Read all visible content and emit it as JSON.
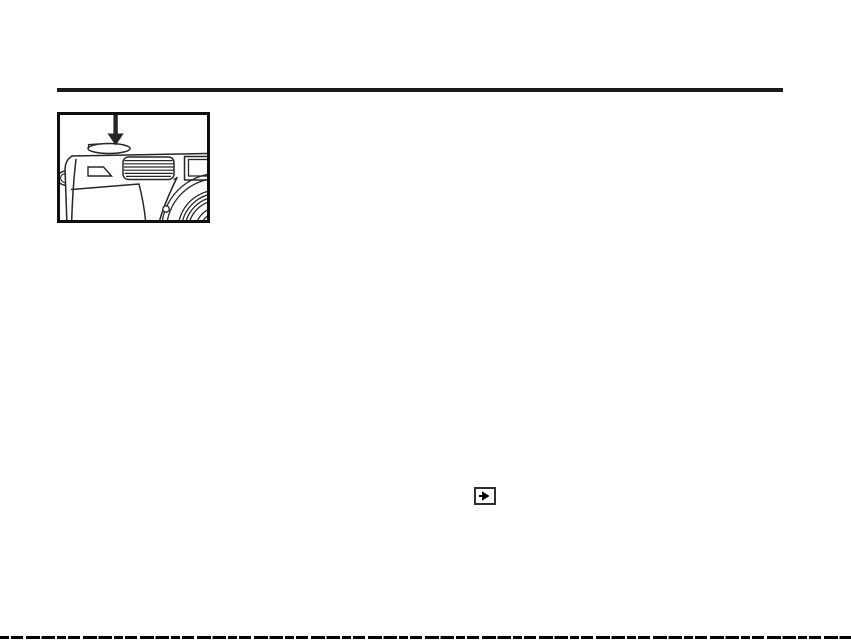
{
  "document": {
    "type": "scanned-manual-page",
    "background": "#ffffff",
    "visible_text": ""
  },
  "colors": {
    "rule": "#1b1b1b",
    "ink": "#262626",
    "frame": "#0f0f0f",
    "icon_border": "#2e2e2e",
    "icon_glyph": "#000000"
  },
  "figure": {
    "name": "camera-shutter-button-illustration",
    "alt": "Line drawing of the top-left corner of a compact camera with a bold arrow pointing down at the shutter button",
    "parts": [
      "down-arrow-icon",
      "shutter-button",
      "self-timer-window",
      "flash-grille",
      "viewfinder-window",
      "lens-barrel-rings",
      "strap-lug",
      "screw-dot"
    ]
  },
  "inline_icon": {
    "name": "playback-mode-icon",
    "glyph": "▶"
  }
}
